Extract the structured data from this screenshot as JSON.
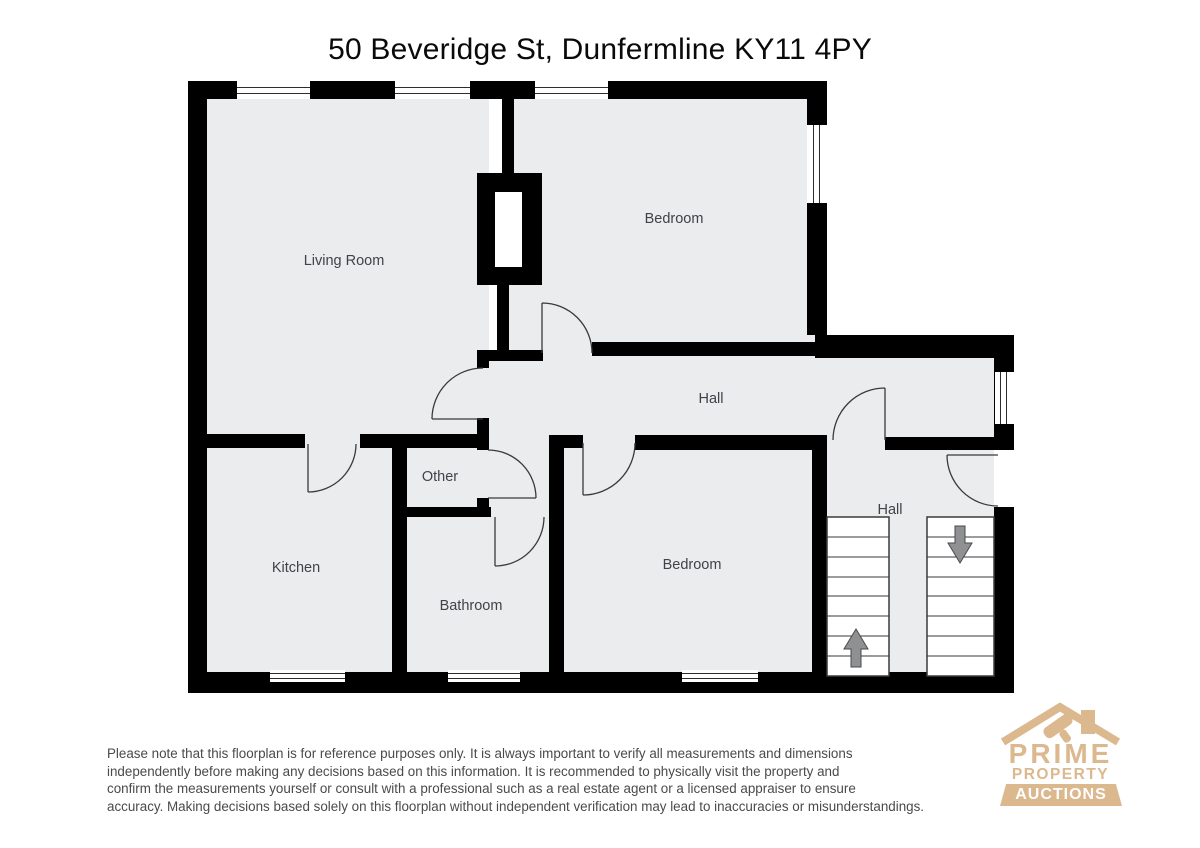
{
  "title": "50 Beveridge St, Dunfermline KY11 4PY",
  "rooms": [
    {
      "label": "Living Room"
    },
    {
      "label": "Bedroom"
    },
    {
      "label": "Hall"
    },
    {
      "label": "Other"
    },
    {
      "label": "Kitchen"
    },
    {
      "label": "Bathroom"
    },
    {
      "label": "Bedroom"
    },
    {
      "label": "Hall"
    }
  ],
  "stairs": {
    "up_arrow": "stairs-up",
    "down_arrow": "stairs-down"
  },
  "disclaimer": {
    "lines": [
      "Please note that this floorplan is for reference purposes only. It is always important to verify all measurements and dimensions",
      "independently before making any decisions based on this information. It is recommended to physically visit the property and",
      "confirm the measurements yourself or consult with a professional such as a real estate agent or a licensed appraiser to ensure",
      "accuracy. Making decisions based solely on this floorplan without independent verification may lead to inaccuracies or misunderstandings."
    ]
  },
  "logo": {
    "line1": "PRIME",
    "line2": "PROPERTY",
    "line3": "AUCTIONS"
  },
  "colors": {
    "wall": "#000000",
    "floor": "#ebecee",
    "line": "#3a3a3a",
    "label": "#3f4347",
    "muted": "#4a4a4a",
    "logo_tan": "#dcb88f",
    "arrow": "#8f9092"
  }
}
